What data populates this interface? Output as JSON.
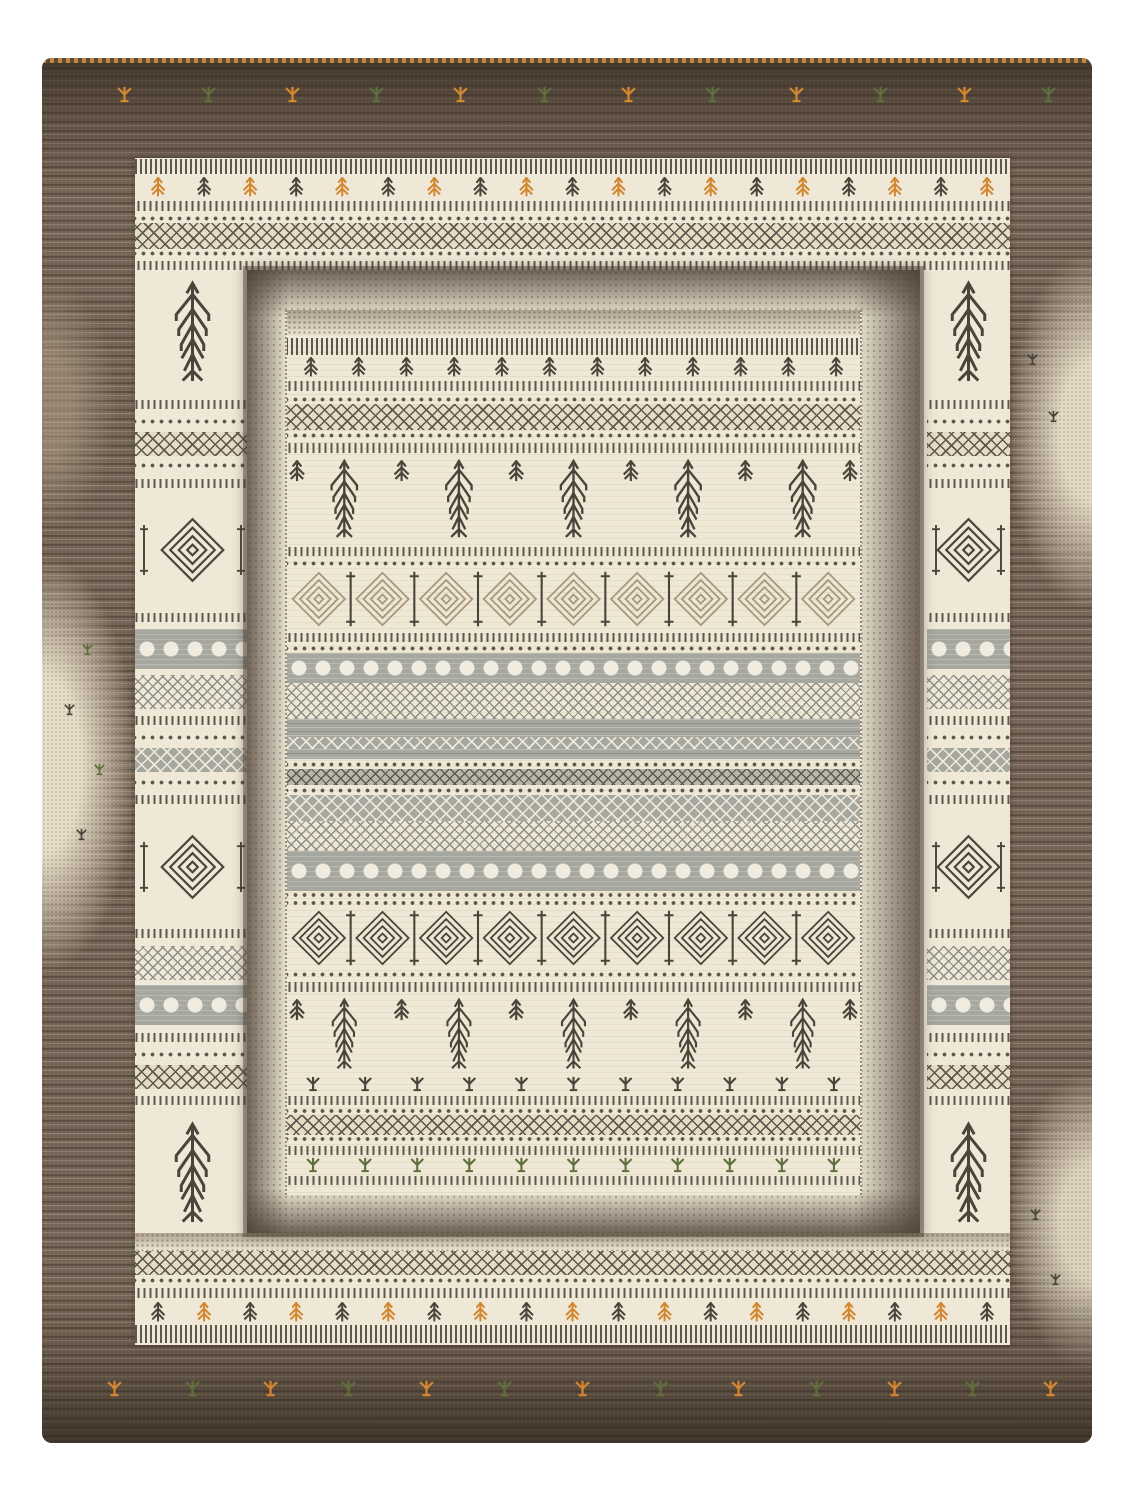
{
  "image": {
    "subject": "top view product photo of a rectangular Gabbeh-style hand-loomed wool rug with tribal geometric pattern bands",
    "background": "#ffffff"
  },
  "palette": {
    "bg": "#ffffff",
    "rugBrown": "#79695a",
    "ink": "#4a443b",
    "ink2": "#5d574c",
    "cream": "#efe8d6",
    "cream2": "#e2d8c2",
    "grey": "#a6a8a0",
    "grey2": "#8c8e88",
    "tan2": "#a8977c",
    "orange": "#d2862f",
    "olive": "#5f6f3e",
    "shadow": "#3f352c"
  },
  "rug": {
    "x": 42,
    "y": 58,
    "w": 1050,
    "h": 1385,
    "outer_border": {
      "texture": "heathered brown wool, darker at top and bottom, cream abrash patches on sides",
      "top_row": {
        "y": 28,
        "x0": 75,
        "pitch": 84,
        "count": 12,
        "colors": [
          "orange",
          "olive"
        ]
      },
      "bottom_row": {
        "y": 1322,
        "x0": 65,
        "pitch": 78,
        "count": 13,
        "colors": [
          "orange",
          "olive"
        ]
      },
      "spots": [
        {
          "x": 40,
          "y": 585,
          "c": "olive"
        },
        {
          "x": 22,
          "y": 645,
          "c": "ink"
        },
        {
          "x": 52,
          "y": 705,
          "c": "olive"
        },
        {
          "x": 34,
          "y": 770,
          "c": "ink"
        },
        {
          "x": 985,
          "y": 295,
          "c": "ink"
        },
        {
          "x": 1006,
          "y": 352,
          "c": "ink"
        },
        {
          "x": 988,
          "y": 1150,
          "c": "ink"
        },
        {
          "x": 1008,
          "y": 1215,
          "c": "ink"
        }
      ]
    },
    "ring2": {
      "left": 93,
      "top": 100,
      "w": 875,
      "h": 1187,
      "col_w_left": 115,
      "col_w_right": 83,
      "corner_h": 120,
      "corner_motif": "pine-tree",
      "top_rows": [
        {
          "t": "fringe",
          "h": 18
        },
        {
          "t": "trees-alt",
          "h": 22,
          "c": [
            "orange",
            "ink"
          ]
        },
        {
          "t": "tick",
          "h": 16
        },
        {
          "t": "dots",
          "h": 9
        },
        {
          "t": "lattice",
          "h": 26
        },
        {
          "t": "dots",
          "h": 9
        },
        {
          "t": "tick",
          "h": 14
        }
      ],
      "bottom_rows": [
        {
          "t": "speckle",
          "h": 18
        },
        {
          "t": "lattice",
          "h": 24
        },
        {
          "t": "dots",
          "h": 10
        },
        {
          "t": "tick",
          "h": 16
        },
        {
          "t": "trees-alt",
          "h": 22,
          "c": [
            "ink",
            "orange"
          ]
        },
        {
          "t": "fringe",
          "h": 22
        }
      ],
      "side_segments": [
        {
          "t": "tick",
          "h": 14
        },
        {
          "t": "dots",
          "h": 10
        },
        {
          "t": "lattice",
          "h": 24
        },
        {
          "t": "dots",
          "h": 10
        },
        {
          "t": "tick",
          "h": 14
        },
        {
          "t": "medallion",
          "h": 110
        },
        {
          "t": "tick",
          "h": 14
        },
        {
          "t": "greydots",
          "h": 40
        },
        {
          "t": "cross",
          "h": 34
        },
        {
          "t": "tick",
          "h": 14
        },
        {
          "t": "dots",
          "h": 10
        },
        {
          "t": "greyzz",
          "h": 24
        },
        {
          "t": "dots",
          "h": 10
        },
        {
          "t": "tick",
          "h": 14
        },
        {
          "t": "medallion",
          "h": 110
        },
        {
          "t": "tick",
          "h": 14
        },
        {
          "t": "cross",
          "h": 34
        },
        {
          "t": "greydots",
          "h": 40
        },
        {
          "t": "tick",
          "h": 14
        },
        {
          "t": "dots",
          "h": 10
        },
        {
          "t": "lattice",
          "h": 24
        },
        {
          "t": "tick",
          "h": 14
        }
      ]
    },
    "shadow_frame": {
      "left": 205,
      "top": 212,
      "w": 673,
      "h": 963
    },
    "field": {
      "left": 243,
      "top": 252,
      "w": 573,
      "h": 885,
      "bands": [
        {
          "t": "speckle",
          "h": 26
        },
        {
          "t": "fringe",
          "h": 20
        },
        {
          "t": "trees-alt",
          "h": 22,
          "c": [
            "ink"
          ]
        },
        {
          "t": "tick",
          "h": 16
        },
        {
          "t": "dots",
          "h": 10
        },
        {
          "t": "lattice",
          "h": 26
        },
        {
          "t": "dots",
          "h": 10
        },
        {
          "t": "tick",
          "h": 16
        },
        {
          "t": "pines",
          "h": 88
        },
        {
          "t": "tick",
          "h": 14
        },
        {
          "t": "dots",
          "h": 10
        },
        {
          "t": "big-diamonds",
          "h": 62,
          "c": "tan2"
        },
        {
          "t": "tick",
          "h": 14
        },
        {
          "t": "dots",
          "h": 9
        },
        {
          "t": "greydots",
          "h": 30
        },
        {
          "t": "cross",
          "h": 36
        },
        {
          "t": "grey",
          "h": 18
        },
        {
          "t": "greyzz",
          "h": 12
        },
        {
          "t": "grey",
          "h": 10
        },
        {
          "t": "dots",
          "h": 10
        },
        {
          "t": "greydia",
          "h": 16
        },
        {
          "t": "dots",
          "h": 10
        },
        {
          "t": "greyzz",
          "h": 26
        },
        {
          "t": "cross",
          "h": 30
        },
        {
          "t": "greydots",
          "h": 40
        },
        {
          "t": "dots",
          "h": 8
        },
        {
          "t": "dots",
          "h": 8
        },
        {
          "t": "big-diamonds",
          "h": 62,
          "c": "ink"
        },
        {
          "t": "dots",
          "h": 10
        },
        {
          "t": "tick",
          "h": 16
        },
        {
          "t": "pines",
          "h": 80
        },
        {
          "t": "plants",
          "h": 18,
          "c": [
            "ink"
          ]
        },
        {
          "t": "tick",
          "h": 14
        },
        {
          "t": "dots",
          "h": 8
        },
        {
          "t": "lattice",
          "h": 20
        },
        {
          "t": "dots",
          "h": 8
        },
        {
          "t": "tick",
          "h": 14
        },
        {
          "t": "plants",
          "h": 16,
          "c": [
            "olive"
          ]
        },
        {
          "t": "tick",
          "h": 14
        }
      ]
    }
  }
}
